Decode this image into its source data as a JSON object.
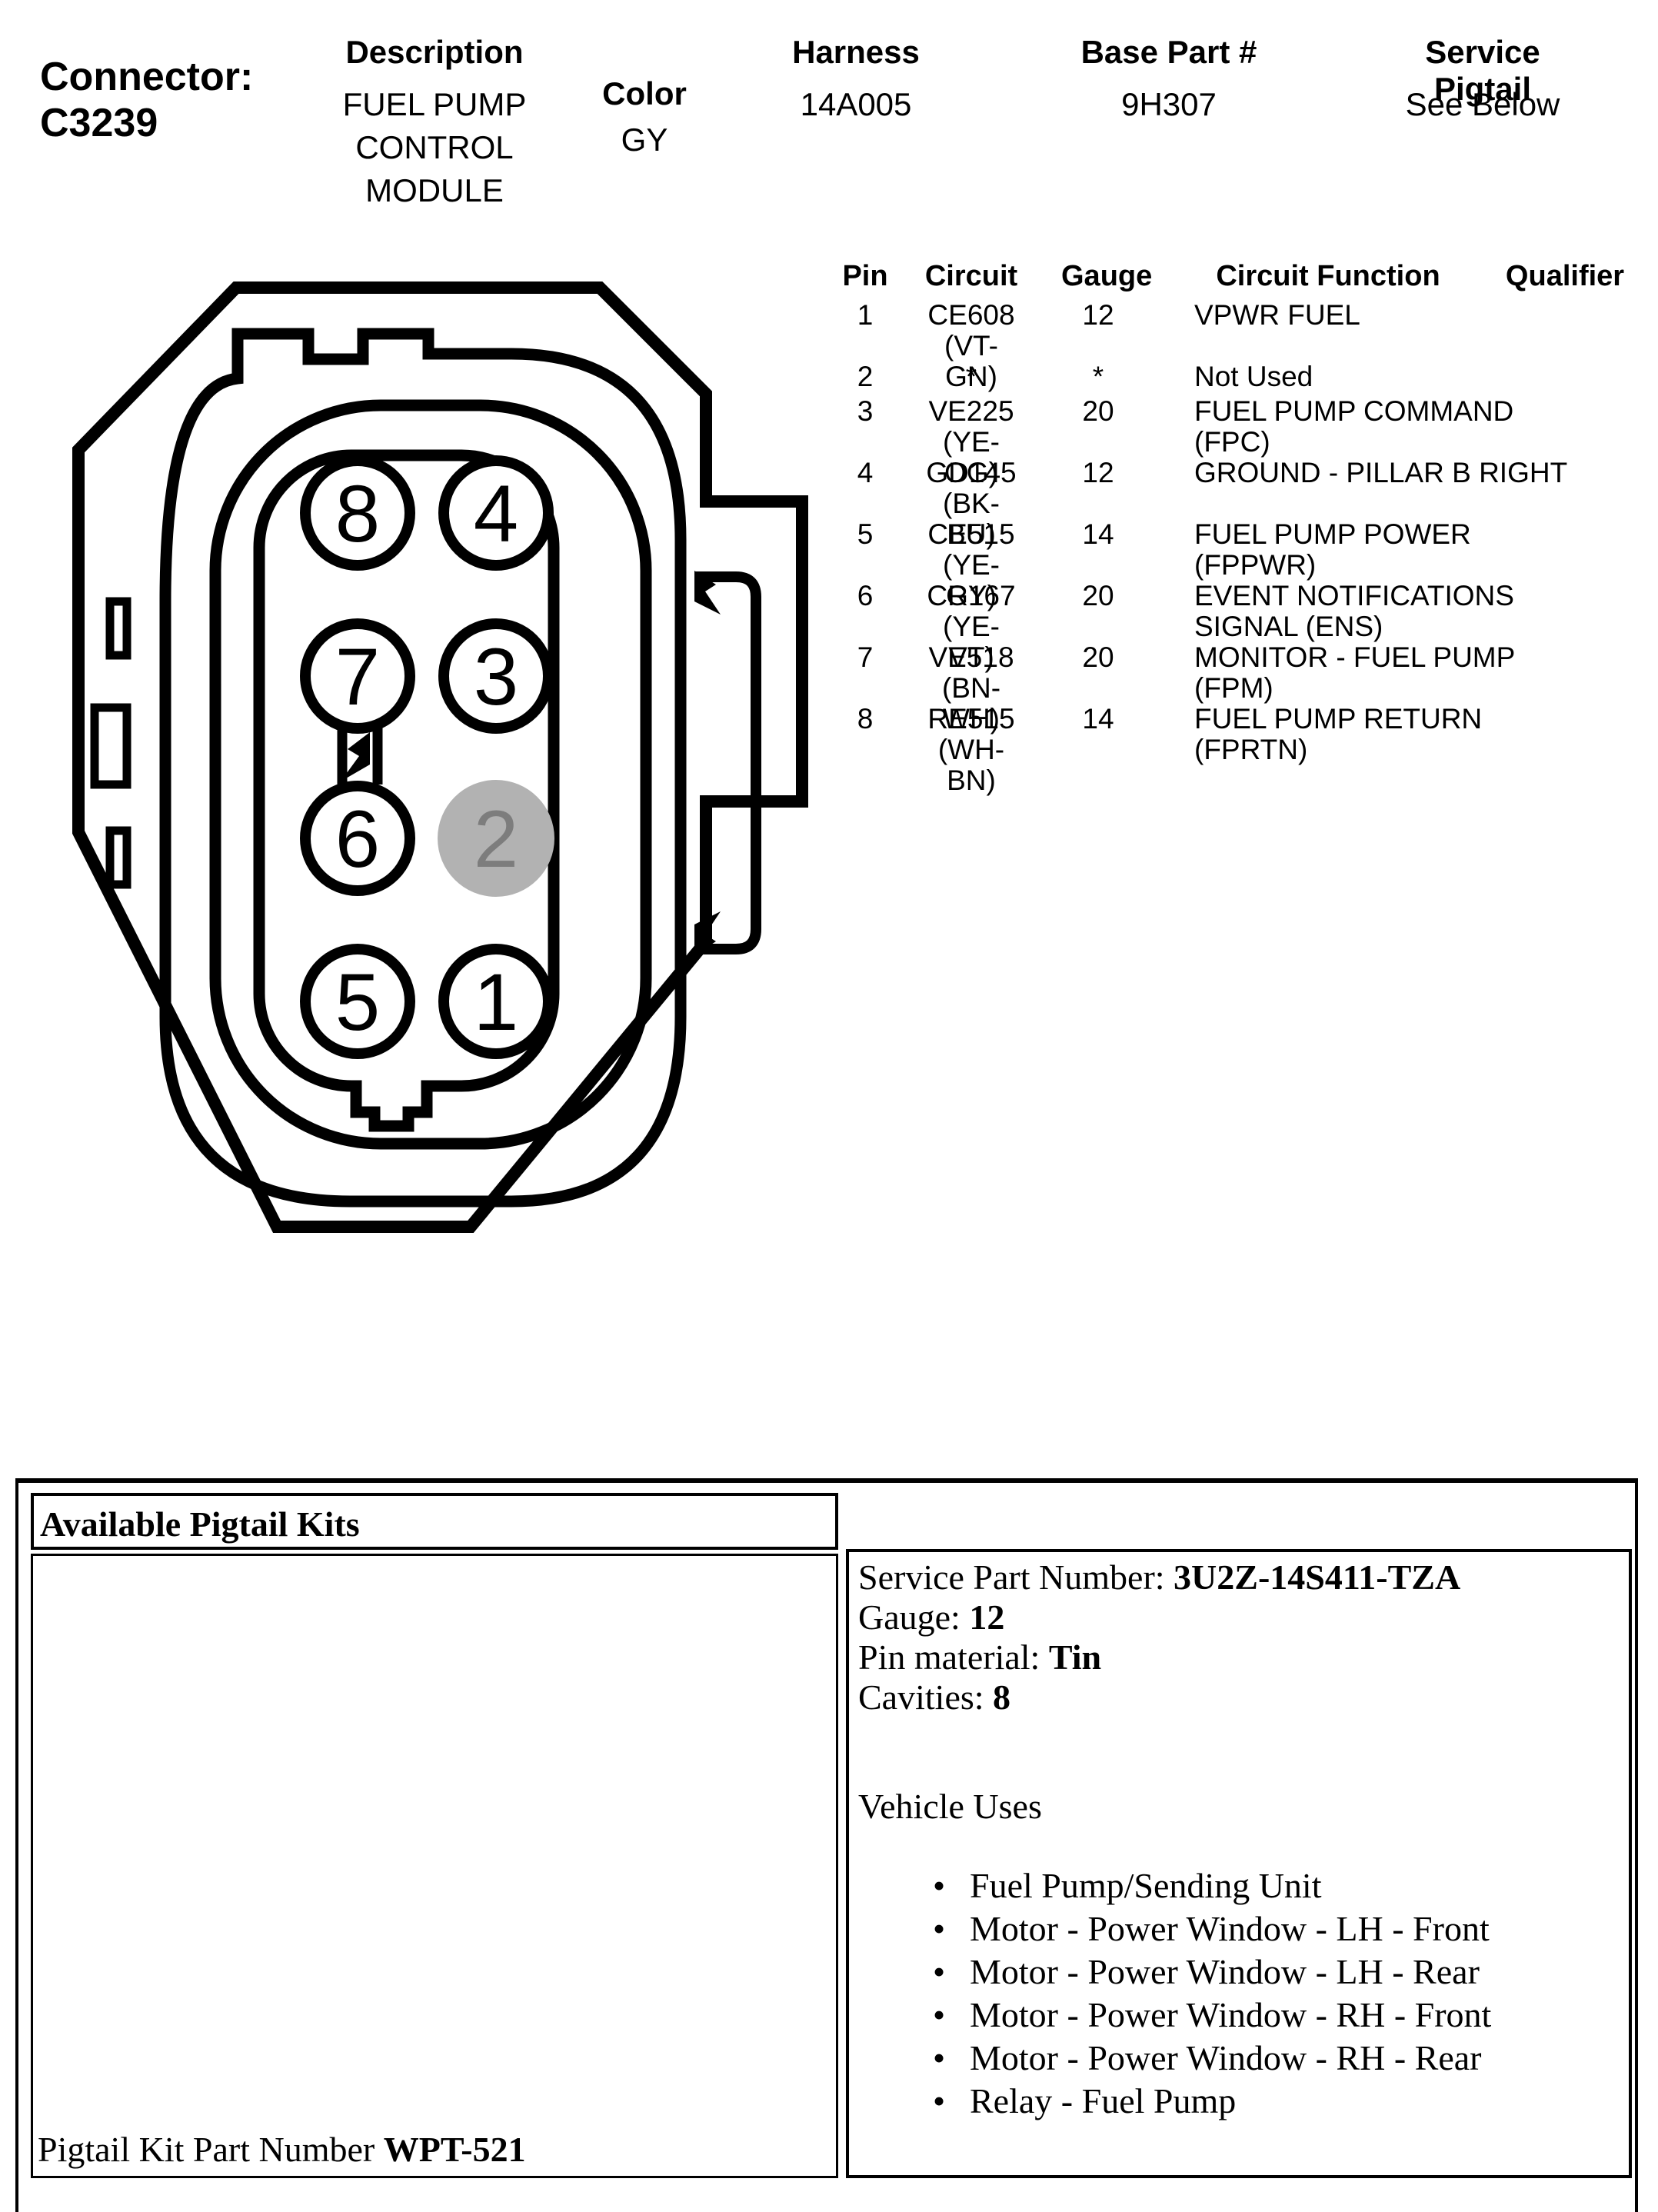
{
  "header": {
    "connector_label": "Connector:",
    "connector_id": "C3239",
    "columns": {
      "description": {
        "label": "Description",
        "lines": [
          "FUEL PUMP",
          "CONTROL",
          "MODULE"
        ]
      },
      "color": {
        "label": "Color",
        "value": "GY"
      },
      "harness": {
        "label": "Harness",
        "value": "14A005"
      },
      "base_part": {
        "label": "Base Part #",
        "value": "9H307"
      },
      "service_pigtail": {
        "label": "Service Pigtail",
        "value": "See Below"
      }
    }
  },
  "pin_table": {
    "headers": {
      "pin": "Pin",
      "circuit": "Circuit",
      "gauge": "Gauge",
      "function": "Circuit Function",
      "qualifier": "Qualifier"
    },
    "rows": [
      {
        "pin": "1",
        "circuit_lines": [
          "CE608 (VT-",
          "GN)"
        ],
        "gauge": "12",
        "function_lines": [
          "VPWR FUEL"
        ]
      },
      {
        "pin": "2",
        "circuit_lines": [
          "*"
        ],
        "gauge": "*",
        "function_lines": [
          "Not Used"
        ]
      },
      {
        "pin": "3",
        "circuit_lines": [
          "VE225 (YE-",
          "OG)"
        ],
        "gauge": "20",
        "function_lines": [
          "FUEL PUMP COMMAND",
          "(FPC)"
        ]
      },
      {
        "pin": "4",
        "circuit_lines": [
          "GD145 (BK-",
          "BU)"
        ],
        "gauge": "12",
        "function_lines": [
          "GROUND - PILLAR B RIGHT"
        ]
      },
      {
        "pin": "5",
        "circuit_lines": [
          "CE515 (YE-",
          "GY)"
        ],
        "gauge": "14",
        "function_lines": [
          "FUEL PUMP POWER",
          "(FPPWR)"
        ]
      },
      {
        "pin": "6",
        "circuit_lines": [
          "CR167 (YE-",
          "VT)"
        ],
        "gauge": "20",
        "function_lines": [
          "EVENT NOTIFICATIONS",
          "SIGNAL (ENS)"
        ]
      },
      {
        "pin": "7",
        "circuit_lines": [
          "VE518 (BN-",
          "WH)"
        ],
        "gauge": "20",
        "function_lines": [
          "MONITOR - FUEL PUMP",
          "(FPM)"
        ]
      },
      {
        "pin": "8",
        "circuit_lines": [
          "RE515 (WH-",
          "BN)"
        ],
        "gauge": "14",
        "function_lines": [
          "FUEL PUMP RETURN",
          "(FPRTN)"
        ]
      }
    ]
  },
  "connector_diagram": {
    "pin_labels": {
      "p1": "1",
      "p2": "2",
      "p3": "3",
      "p4": "4",
      "p5": "5",
      "p6": "6",
      "p7": "7",
      "p8": "8"
    },
    "grayed_pin": "2",
    "outline_color": "#000000",
    "gray_fill": "#b2b2b2",
    "gray_text": "#7d7d7d"
  },
  "pigtail_section": {
    "title": "Available Pigtail Kits",
    "service_part_label": "Service Part Number: ",
    "service_part_value": "3U2Z-14S411-TZA",
    "gauge_label": "Gauge: ",
    "gauge_value": "12",
    "pin_material_label": "Pin material: ",
    "pin_material_value": "Tin",
    "cavities_label": "Cavities: ",
    "cavities_value": "8",
    "vehicle_uses_title": "Vehicle Uses",
    "bullet": "•",
    "vehicle_uses": [
      "Fuel Pump/Sending Unit",
      "Motor - Power Window - LH - Front",
      "Motor - Power Window - LH - Rear",
      "Motor - Power Window - RH - Front",
      "Motor - Power Window - RH - Rear",
      "Relay - Fuel Pump"
    ],
    "kit_label": "Pigtail Kit Part Number ",
    "kit_value": "WPT-521"
  }
}
